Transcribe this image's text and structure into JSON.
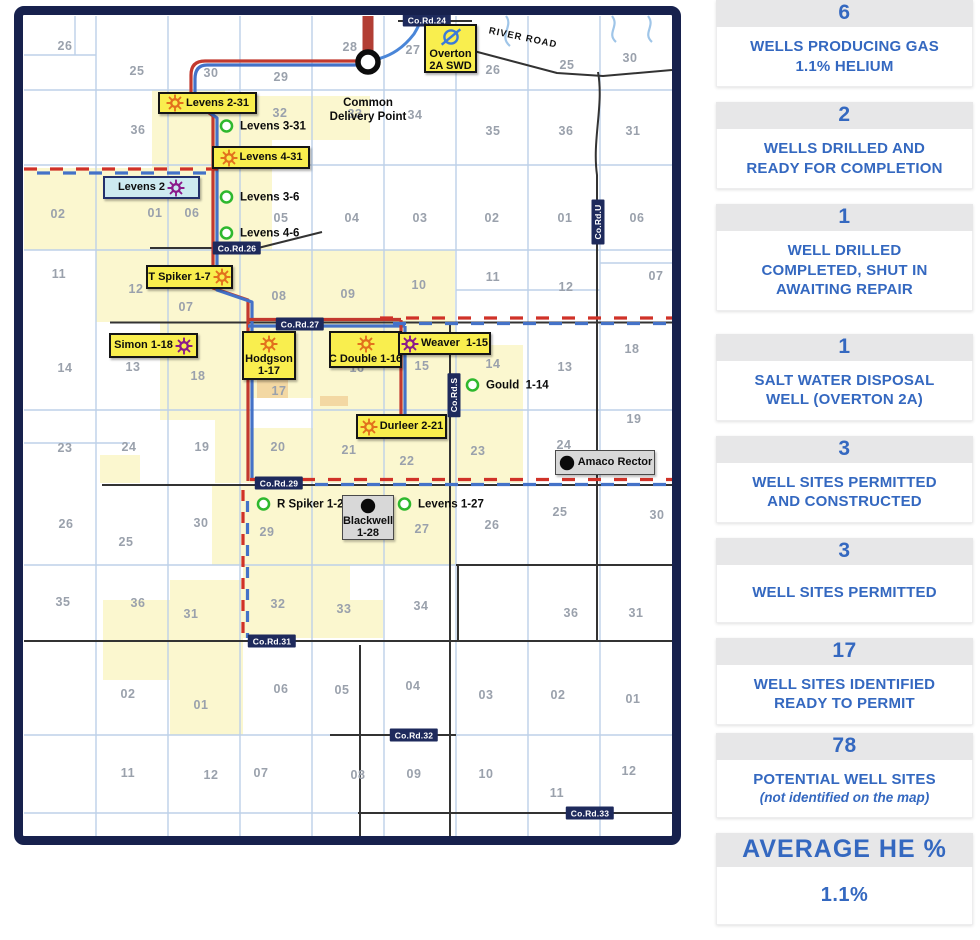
{
  "map": {
    "colors": {
      "map_border_navy": "#17214d",
      "label_yellow": "#f9ee4e",
      "shutin_cyan": "#cdeaf0",
      "producing_orange": "#e2711d",
      "ready_purple": "#8b1a8b",
      "permitted_green": "#2eb82e",
      "swd_blue": "#3b7ad9",
      "pipeline_red": "#c2392e",
      "pipeline_blue": "#4472c8",
      "section_fill_yellow": "#fbf7cf",
      "grid_blue": "#bdd0e8"
    },
    "river_road_label": "RIVER ROAD",
    "delivery_point_label": "Common\nDelivery Point",
    "road_chips": [
      {
        "text": "Co.Rd.24",
        "x": 427,
        "y": 20
      },
      {
        "text": "Co.Rd.26",
        "x": 237,
        "y": 248
      },
      {
        "text": "Co.Rd.27",
        "x": 300,
        "y": 324
      },
      {
        "text": "Co.Rd.29",
        "x": 279,
        "y": 483
      },
      {
        "text": "Co.Rd.31",
        "x": 272,
        "y": 641
      },
      {
        "text": "Co.Rd.32",
        "x": 414,
        "y": 735
      },
      {
        "text": "Co.Rd.33",
        "x": 590,
        "y": 813
      },
      {
        "text": "Co.Rd.U",
        "x": 598,
        "y": 222,
        "vertical": true
      },
      {
        "text": "Co.Rd.S",
        "x": 454,
        "y": 395,
        "vertical": true
      }
    ],
    "boxed_wells": [
      {
        "id": "levens-2-31",
        "text": "Levens 2-31",
        "style": "producing",
        "icon_pos": "left",
        "x": 158,
        "y": 92,
        "w": 99,
        "h": 22
      },
      {
        "id": "levens-4-31",
        "text": "Levens 4-31",
        "style": "producing",
        "icon_pos": "left",
        "x": 212,
        "y": 146,
        "w": 98,
        "h": 23
      },
      {
        "id": "levens-2",
        "text": "Levens 2",
        "style": "shutin",
        "icon_pos": "right",
        "x": 103,
        "y": 176,
        "w": 97,
        "h": 23
      },
      {
        "id": "t-spiker-1-7",
        "text": "T Spiker 1-7",
        "style": "producing",
        "icon_pos": "right",
        "x": 146,
        "y": 265,
        "w": 87,
        "h": 24
      },
      {
        "id": "simon-1-18",
        "text": "Simon 1-18",
        "style": "ready",
        "icon_pos": "right",
        "x": 109,
        "y": 333,
        "w": 89,
        "h": 25
      },
      {
        "id": "hodgson-1-17",
        "lines": [
          "Hodgson",
          "1-17"
        ],
        "style": "producing",
        "icon_pos": "top",
        "x": 242,
        "y": 331,
        "w": 54,
        "h": 49
      },
      {
        "id": "c-double-1-16",
        "text": "C Double 1-16",
        "style": "producing",
        "icon_pos": "top",
        "x": 329,
        "y": 331,
        "w": 73,
        "h": 37
      },
      {
        "id": "weaver-1-15",
        "text": "Weaver  1-15",
        "style": "ready",
        "icon_pos": "left",
        "x": 398,
        "y": 332,
        "w": 93,
        "h": 23
      },
      {
        "id": "durleer-2-21",
        "text": "Durleer 2-21",
        "style": "producing",
        "icon_pos": "left",
        "x": 356,
        "y": 414,
        "w": 91,
        "h": 25
      },
      {
        "id": "overton-2a-swd",
        "lines": [
          "Overton",
          "2A SWD"
        ],
        "style": "swd",
        "icon_pos": "top",
        "x": 424,
        "y": 24,
        "w": 53,
        "h": 49
      },
      {
        "id": "blackwell-1-28",
        "lines": [
          "Blackwell",
          "1-28"
        ],
        "style": "gray",
        "icon_pos": "top",
        "x": 342,
        "y": 495,
        "w": 52,
        "h": 45
      },
      {
        "id": "amaco-rector",
        "text": "Amaco Rector",
        "style": "gray",
        "icon_pos": "left",
        "x": 555,
        "y": 450,
        "w": 100,
        "h": 25
      }
    ],
    "circled_wells": [
      {
        "id": "levens-3-31",
        "text": "Levens 3-31",
        "x": 227,
        "y": 126
      },
      {
        "id": "levens-3-6",
        "text": "Levens 3-6",
        "x": 227,
        "y": 197
      },
      {
        "id": "levens-4-6",
        "text": "Levens 4-6",
        "x": 227,
        "y": 233
      },
      {
        "id": "gould-1-14",
        "text": "Gould  1-14",
        "x": 473,
        "y": 385
      },
      {
        "id": "r-spiker-1-29",
        "text": "R Spiker 1-29",
        "x": 264,
        "y": 504
      },
      {
        "id": "levens-1-27",
        "text": "Levens 1-27",
        "x": 405,
        "y": 504
      }
    ],
    "section_numbers": [
      {
        "t": "26",
        "x": 65,
        "y": 46
      },
      {
        "t": "25",
        "x": 137,
        "y": 71
      },
      {
        "t": "30",
        "x": 211,
        "y": 73
      },
      {
        "t": "29",
        "x": 281,
        "y": 77
      },
      {
        "t": "28",
        "x": 350,
        "y": 47
      },
      {
        "t": "27",
        "x": 413,
        "y": 50
      },
      {
        "t": "26",
        "x": 493,
        "y": 70
      },
      {
        "t": "25",
        "x": 567,
        "y": 65
      },
      {
        "t": "30",
        "x": 630,
        "y": 58
      },
      {
        "t": "36",
        "x": 138,
        "y": 130
      },
      {
        "t": "32",
        "x": 280,
        "y": 113
      },
      {
        "t": "33",
        "x": 355,
        "y": 114
      },
      {
        "t": "34",
        "x": 415,
        "y": 115
      },
      {
        "t": "35",
        "x": 493,
        "y": 131
      },
      {
        "t": "36",
        "x": 566,
        "y": 131
      },
      {
        "t": "31",
        "x": 633,
        "y": 131
      },
      {
        "t": "02",
        "x": 58,
        "y": 214
      },
      {
        "t": "01",
        "x": 155,
        "y": 213
      },
      {
        "t": "06",
        "x": 192,
        "y": 213
      },
      {
        "t": "05",
        "x": 281,
        "y": 218
      },
      {
        "t": "04",
        "x": 352,
        "y": 218
      },
      {
        "t": "03",
        "x": 420,
        "y": 218
      },
      {
        "t": "02",
        "x": 492,
        "y": 218
      },
      {
        "t": "01",
        "x": 565,
        "y": 218
      },
      {
        "t": "06",
        "x": 637,
        "y": 218
      },
      {
        "t": "11",
        "x": 59,
        "y": 274
      },
      {
        "t": "12",
        "x": 136,
        "y": 289
      },
      {
        "t": "07",
        "x": 186,
        "y": 307
      },
      {
        "t": "08",
        "x": 279,
        "y": 296
      },
      {
        "t": "09",
        "x": 348,
        "y": 294
      },
      {
        "t": "10",
        "x": 419,
        "y": 285
      },
      {
        "t": "11",
        "x": 493,
        "y": 277
      },
      {
        "t": "12",
        "x": 566,
        "y": 287
      },
      {
        "t": "07",
        "x": 656,
        "y": 276
      },
      {
        "t": "14",
        "x": 65,
        "y": 368
      },
      {
        "t": "13",
        "x": 133,
        "y": 367
      },
      {
        "t": "18",
        "x": 198,
        "y": 376
      },
      {
        "t": "17",
        "x": 279,
        "y": 391
      },
      {
        "t": "16",
        "x": 357,
        "y": 368
      },
      {
        "t": "15",
        "x": 422,
        "y": 366
      },
      {
        "t": "14",
        "x": 493,
        "y": 364
      },
      {
        "t": "13",
        "x": 565,
        "y": 367
      },
      {
        "t": "18",
        "x": 632,
        "y": 349
      },
      {
        "t": "23",
        "x": 65,
        "y": 448
      },
      {
        "t": "24",
        "x": 129,
        "y": 447
      },
      {
        "t": "19",
        "x": 202,
        "y": 447
      },
      {
        "t": "20",
        "x": 278,
        "y": 447
      },
      {
        "t": "21",
        "x": 349,
        "y": 450
      },
      {
        "t": "22",
        "x": 407,
        "y": 461
      },
      {
        "t": "23",
        "x": 478,
        "y": 451
      },
      {
        "t": "24",
        "x": 564,
        "y": 445
      },
      {
        "t": "19",
        "x": 634,
        "y": 419
      },
      {
        "t": "26",
        "x": 66,
        "y": 524
      },
      {
        "t": "25",
        "x": 126,
        "y": 542
      },
      {
        "t": "30",
        "x": 201,
        "y": 523
      },
      {
        "t": "29",
        "x": 267,
        "y": 532
      },
      {
        "t": "27",
        "x": 422,
        "y": 529
      },
      {
        "t": "26",
        "x": 492,
        "y": 525
      },
      {
        "t": "25",
        "x": 560,
        "y": 512
      },
      {
        "t": "30",
        "x": 657,
        "y": 515
      },
      {
        "t": "35",
        "x": 63,
        "y": 602
      },
      {
        "t": "36",
        "x": 138,
        "y": 603
      },
      {
        "t": "31",
        "x": 191,
        "y": 614
      },
      {
        "t": "32",
        "x": 278,
        "y": 604
      },
      {
        "t": "33",
        "x": 344,
        "y": 609
      },
      {
        "t": "34",
        "x": 421,
        "y": 606
      },
      {
        "t": "36",
        "x": 571,
        "y": 613
      },
      {
        "t": "31",
        "x": 636,
        "y": 613
      },
      {
        "t": "02",
        "x": 128,
        "y": 694
      },
      {
        "t": "01",
        "x": 201,
        "y": 705
      },
      {
        "t": "06",
        "x": 281,
        "y": 689
      },
      {
        "t": "05",
        "x": 342,
        "y": 690
      },
      {
        "t": "04",
        "x": 413,
        "y": 686
      },
      {
        "t": "03",
        "x": 486,
        "y": 695
      },
      {
        "t": "02",
        "x": 558,
        "y": 695
      },
      {
        "t": "01",
        "x": 633,
        "y": 699
      },
      {
        "t": "11",
        "x": 128,
        "y": 773
      },
      {
        "t": "12",
        "x": 211,
        "y": 775
      },
      {
        "t": "07",
        "x": 261,
        "y": 773
      },
      {
        "t": "08",
        "x": 358,
        "y": 775
      },
      {
        "t": "09",
        "x": 414,
        "y": 774
      },
      {
        "t": "10",
        "x": 486,
        "y": 774
      },
      {
        "t": "11",
        "x": 557,
        "y": 793
      },
      {
        "t": "12",
        "x": 629,
        "y": 771
      }
    ]
  },
  "sidebar": {
    "blocks": [
      {
        "value": "6",
        "label": "WELLS PRODUCING GAS\n1.1% HELIUM"
      },
      {
        "value": "2",
        "label": "WELLS DRILLED AND\nREADY FOR COMPLETION"
      },
      {
        "value": "1",
        "label": "WELL DRILLED\nCOMPLETED, SHUT IN\nAWAITING REPAIR"
      },
      {
        "value": "1",
        "label": "SALT WATER DISPOSAL\nWELL (OVERTON 2A)"
      },
      {
        "value": "3",
        "label": "WELL SITES PERMITTED\nAND CONSTRUCTED"
      },
      {
        "value": "3",
        "label": "WELL SITES PERMITTED"
      },
      {
        "value": "17",
        "label": "WELL SITES IDENTIFIED\nREADY TO PERMIT"
      },
      {
        "value": "78",
        "label": "POTENTIAL WELL SITES",
        "sublabel": "(not identified on the map)"
      }
    ],
    "average_label": "AVERAGE HE %",
    "average_value": "1.1%"
  }
}
